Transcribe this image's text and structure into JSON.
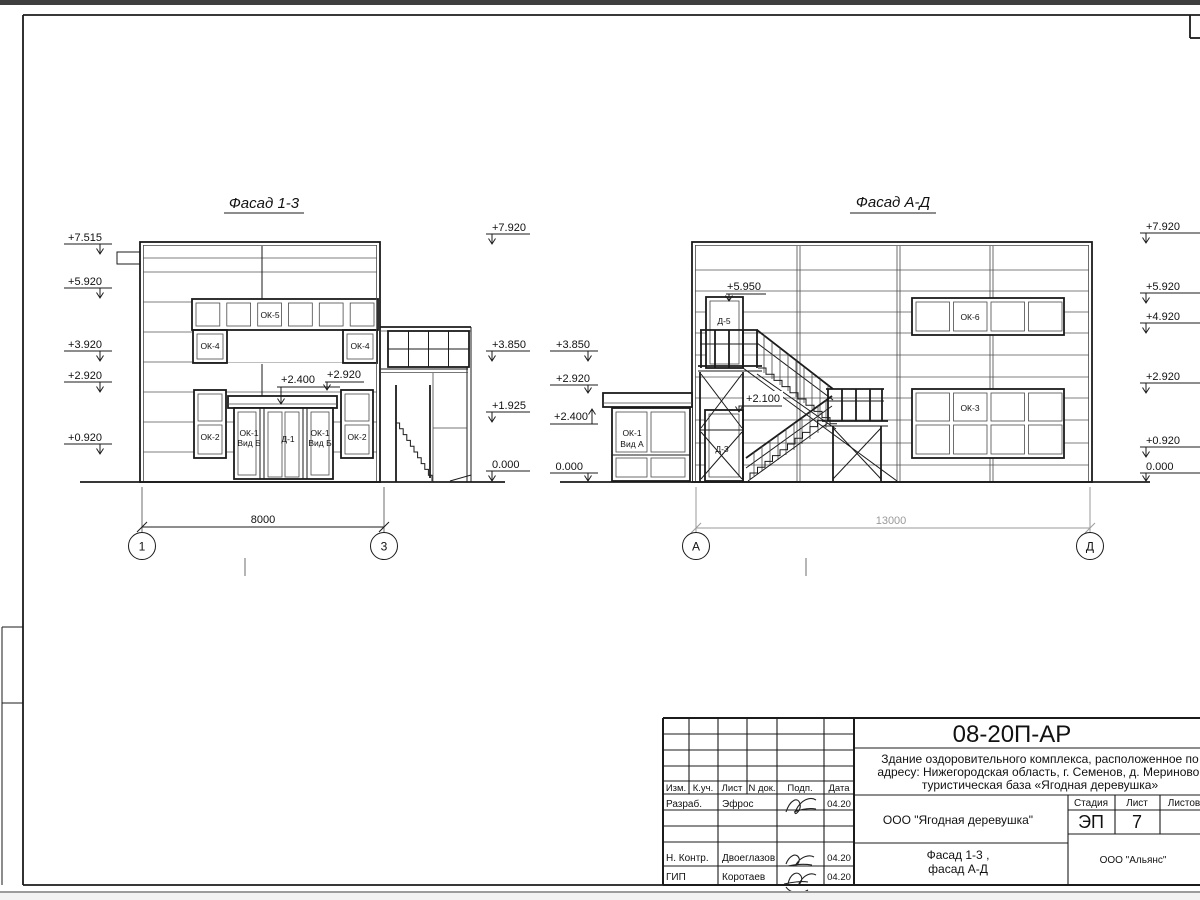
{
  "facade_left": {
    "title": "Фасад 1-3",
    "marks_left": [
      "+7.515",
      "+5.920",
      "+3.920",
      "+2.920",
      "+0.920"
    ],
    "marks_right": [
      "+7.920",
      "+3.850",
      "+1.925",
      "0.000"
    ],
    "ann_canopy": "+2.400",
    "ann_parapet": "+2.920",
    "win": {
      "ok5": "ОК-5",
      "ok4": "ОК-4",
      "ok2": "ОК-2",
      "ok1": "ОК-1",
      "vid": "Вид Б",
      "d1": "Д-1"
    },
    "dim": "8000",
    "axis_a": "1",
    "axis_b": "3"
  },
  "facade_right": {
    "title": "Фасад А-Д",
    "marks_left": [
      "+3.850",
      "+2.920",
      "+2.400",
      "0.000"
    ],
    "marks_right": [
      "+7.920",
      "+5.920",
      "+4.920",
      "+2.920",
      "+0.920",
      "0.000"
    ],
    "ann_d5": "+5.950",
    "ann_d3": "+2.100",
    "win": {
      "ok6": "ОК-6",
      "ok3": "ОК-3",
      "ok1": "ОК-1",
      "vid": "Вид А",
      "d5": "Д-5",
      "d3": "Д-3"
    },
    "dim": "13000",
    "axis_a": "А",
    "axis_b": "Д"
  },
  "title_block": {
    "code": "08-20П-АР",
    "desc1": "Здание оздоровительного комплекса, расположенное по",
    "desc2": "адресу: Нижегородская область, г. Семенов, д. Мериново,",
    "desc3": "туристическая база «Ягодная деревушка»",
    "col_izm": "Изм.",
    "col_kuch": "К.уч.",
    "col_list": "Лист",
    "col_ndoc": "N док.",
    "col_podp": "Подп.",
    "col_data": "Дата",
    "row1_role": "Разраб.",
    "row1_name": "Эфрос",
    "row1_date": "04.20",
    "row4_role": "Н. Контр.",
    "row4_name": "Двоеглазов",
    "row4_date": "04.20",
    "row5_role": "ГИП",
    "row5_name": "Коротаев",
    "row5_date": "04.20",
    "client": "ООО \"Ягодная деревушка\"",
    "stage_label": "Стадия",
    "list_label": "Лист",
    "listov_label": "Листов",
    "stage": "ЭП",
    "sheet_no": "7",
    "dwg1": "Фасад 1-3 ,",
    "dwg2": "фасад А-Д",
    "company": "ООО \"Альянс\""
  }
}
